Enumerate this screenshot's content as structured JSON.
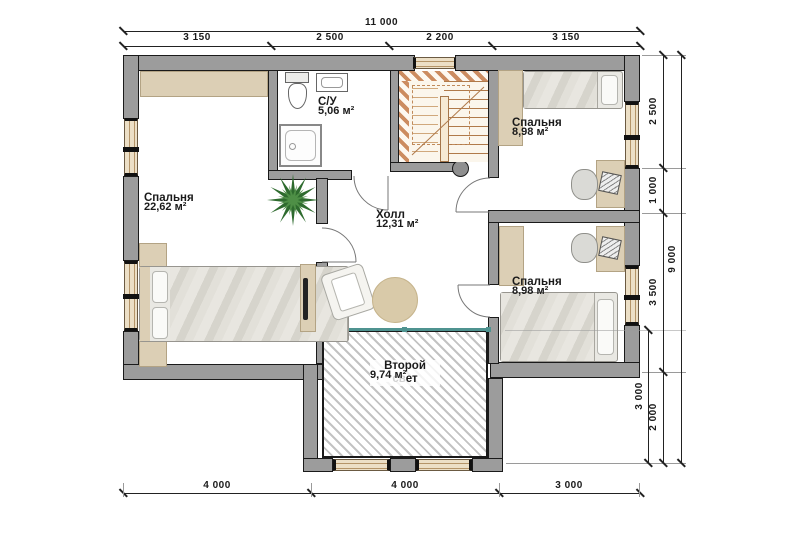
{
  "rooms": {
    "bedroom_left": {
      "name": "Спальня",
      "area": "22,62 м²"
    },
    "bathroom": {
      "name": "С/У",
      "area": "5,06 м²"
    },
    "hall": {
      "name": "Холл",
      "area": "12,31 м²"
    },
    "bedroom_top_right": {
      "name": "Спальня",
      "area": "8,98 м²"
    },
    "bedroom_bottom_right": {
      "name": "Спальня",
      "area": "8,98 м²"
    },
    "void": {
      "name": "Второй свет",
      "area": "9,74 м²"
    }
  },
  "dims": {
    "top_total": "11 000",
    "top_a": "3 150",
    "top_b": "2 500",
    "top_c": "2 200",
    "top_d": "3 150",
    "bottom_a": "4 000",
    "bottom_b": "4 000",
    "bottom_c": "3 000",
    "right_a": "2 500",
    "right_b": "1 000",
    "right_c": "3 500",
    "right_d": "2 000",
    "right_void": "3 000",
    "right_total": "9 000"
  },
  "colors": {
    "wall": "#9c9c9c",
    "wallline": "#1a1a1a",
    "window": "#ecdfc6",
    "beige": "#dccfb5",
    "bedbg": "#e9e8e3",
    "teal": "#4f9390",
    "hatchline": "#c3c3c3",
    "stairline": "#b07a4a",
    "text": "#1a1a1a"
  }
}
